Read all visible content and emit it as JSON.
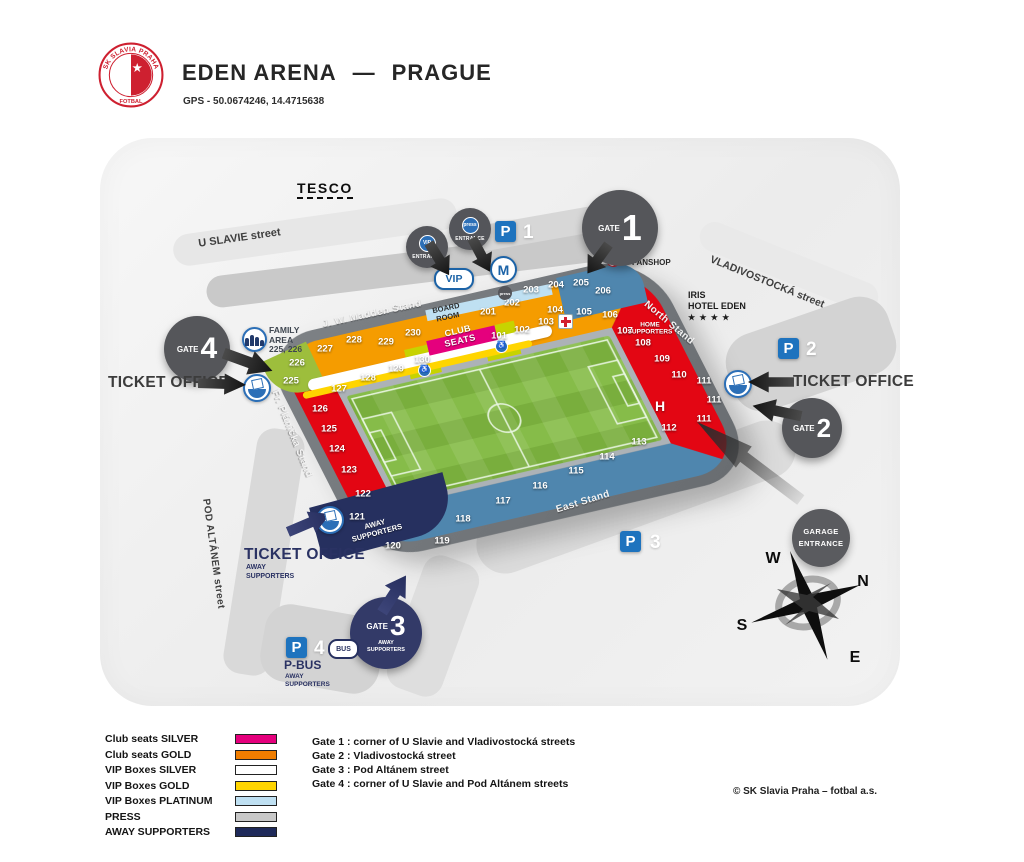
{
  "header": {
    "logo_top": "SK SLAVIA PRAHA",
    "logo_bottom": "FOTBAL",
    "logo_star": "★",
    "title": "EDEN ARENA",
    "dash": "—",
    "city": "PRAGUE",
    "gps": "GPS - 50.0674246, 14.4715638"
  },
  "streets": {
    "tesco": "TESCO",
    "u_slavie": "U SLAVIE street",
    "vladivostocka": "VLADIVOSTOCKÁ street",
    "pod_altanem": "POD ALTÁNEM street"
  },
  "stands": {
    "madden": "J. W. Madden Stand",
    "north": "North Stand",
    "east": "East Stand",
    "planicka": "Fr. Plánička Stand"
  },
  "areas": {
    "club_seats_1": "CLUB",
    "club_seats_2": "SEATS",
    "board_room_1": "BOARD",
    "board_room_2": "ROOM",
    "home_sup_1": "HOME",
    "home_sup_2": "SUPPORTERS",
    "away_sup_1": "AWAY",
    "away_sup_2": "SUPPORTERS",
    "h_marker": "H"
  },
  "sections": {
    "101": "101",
    "102": "102",
    "103": "103",
    "104": "104",
    "105": "105",
    "106": "106",
    "107": "107",
    "108": "108",
    "109": "109",
    "110": "110",
    "111a": "111",
    "111b": "111",
    "111c": "111",
    "112": "112",
    "113": "113",
    "114": "114",
    "115": "115",
    "116": "116",
    "117": "117",
    "118": "118",
    "119": "119",
    "120": "120",
    "121": "121",
    "122": "122",
    "123": "123",
    "124": "124",
    "125": "125",
    "126": "126",
    "127": "127",
    "128": "128",
    "129": "129",
    "130": "130",
    "201": "201",
    "202": "202",
    "203": "203",
    "204": "204",
    "205": "205",
    "206": "206",
    "225": "225",
    "226": "226",
    "227": "227",
    "228": "228",
    "229": "229",
    "230": "230"
  },
  "gates": {
    "gate_word": "GATE",
    "g1": "1",
    "g2": "2",
    "g3": "3",
    "g4": "4",
    "g3_sub1": "AWAY",
    "g3_sub2": "SUPPORTERS"
  },
  "entrances": {
    "vip_badge": "VIP",
    "press_badge": "press",
    "entrance_word": "ENTRANCE",
    "vip_oval": "VIP",
    "mcd": "M",
    "garage_1": "GARAGE",
    "garage_2": "ENTRANCE"
  },
  "parking": {
    "p": "P",
    "n1": "1",
    "n2": "2",
    "n3": "3",
    "n4": "4",
    "bus": "BUS",
    "pbus": "P-BUS",
    "pbus_sub1": "AWAY",
    "pbus_sub2": "SUPPORTERS"
  },
  "ticket_office": {
    "label": "TICKET OFFICE",
    "away_sub1": "AWAY",
    "away_sub2": "SUPPORTERS"
  },
  "family_area": {
    "l1": "FAMILY",
    "l2": "AREA",
    "l3": "225, 226"
  },
  "poi": {
    "fanshop": "FANSHOP",
    "iris_1": "IRIS",
    "iris_2": "HOTEL EDEN",
    "iris_stars": "★ ★ ★ ★"
  },
  "compass": {
    "n": "N",
    "e": "E",
    "s": "S",
    "w": "W"
  },
  "legend": {
    "items": [
      {
        "label": "Club seats SILVER",
        "color": "#E5007D"
      },
      {
        "label": "Club seats GOLD",
        "color": "#F07D00"
      },
      {
        "label": "VIP Boxes SILVER",
        "color": "#FFFFFF"
      },
      {
        "label": "VIP Boxes GOLD",
        "color": "#FFD500"
      },
      {
        "label": "VIP Boxes PLATINUM",
        "color": "#BFE0F2"
      },
      {
        "label": "PRESS",
        "color": "#C8C8C8"
      },
      {
        "label": "AWAY SUPPORTERS",
        "color": "#1F2A5A"
      }
    ],
    "gate_lines": [
      "Gate 1 : corner of U Slavie and Vladivostocká streets",
      "Gate 2 : Vladivostocká street",
      "Gate 3 : Pod Altánem street",
      "Gate 4 : corner of U Slavie and Pod Altánem streets"
    ]
  },
  "footer": {
    "copyright": "© SK Slavia Praha – fotbal a.s."
  },
  "colors": {
    "red": "#E30613",
    "orange": "#F59C00",
    "stblue": "#4F86AE",
    "navy": "#26305F",
    "green": "#9DBE3C",
    "lime": "#C7D300",
    "magenta": "#E5007D",
    "yellow": "#FFD500",
    "platinum": "#BFE0F2",
    "press": "#C8C8C8",
    "pblue": "#1E73BE",
    "gate_gray": "#55565A",
    "gate_navy": "#333A68",
    "pitch1": "#79AE3D",
    "pitch2": "#86BC49"
  }
}
